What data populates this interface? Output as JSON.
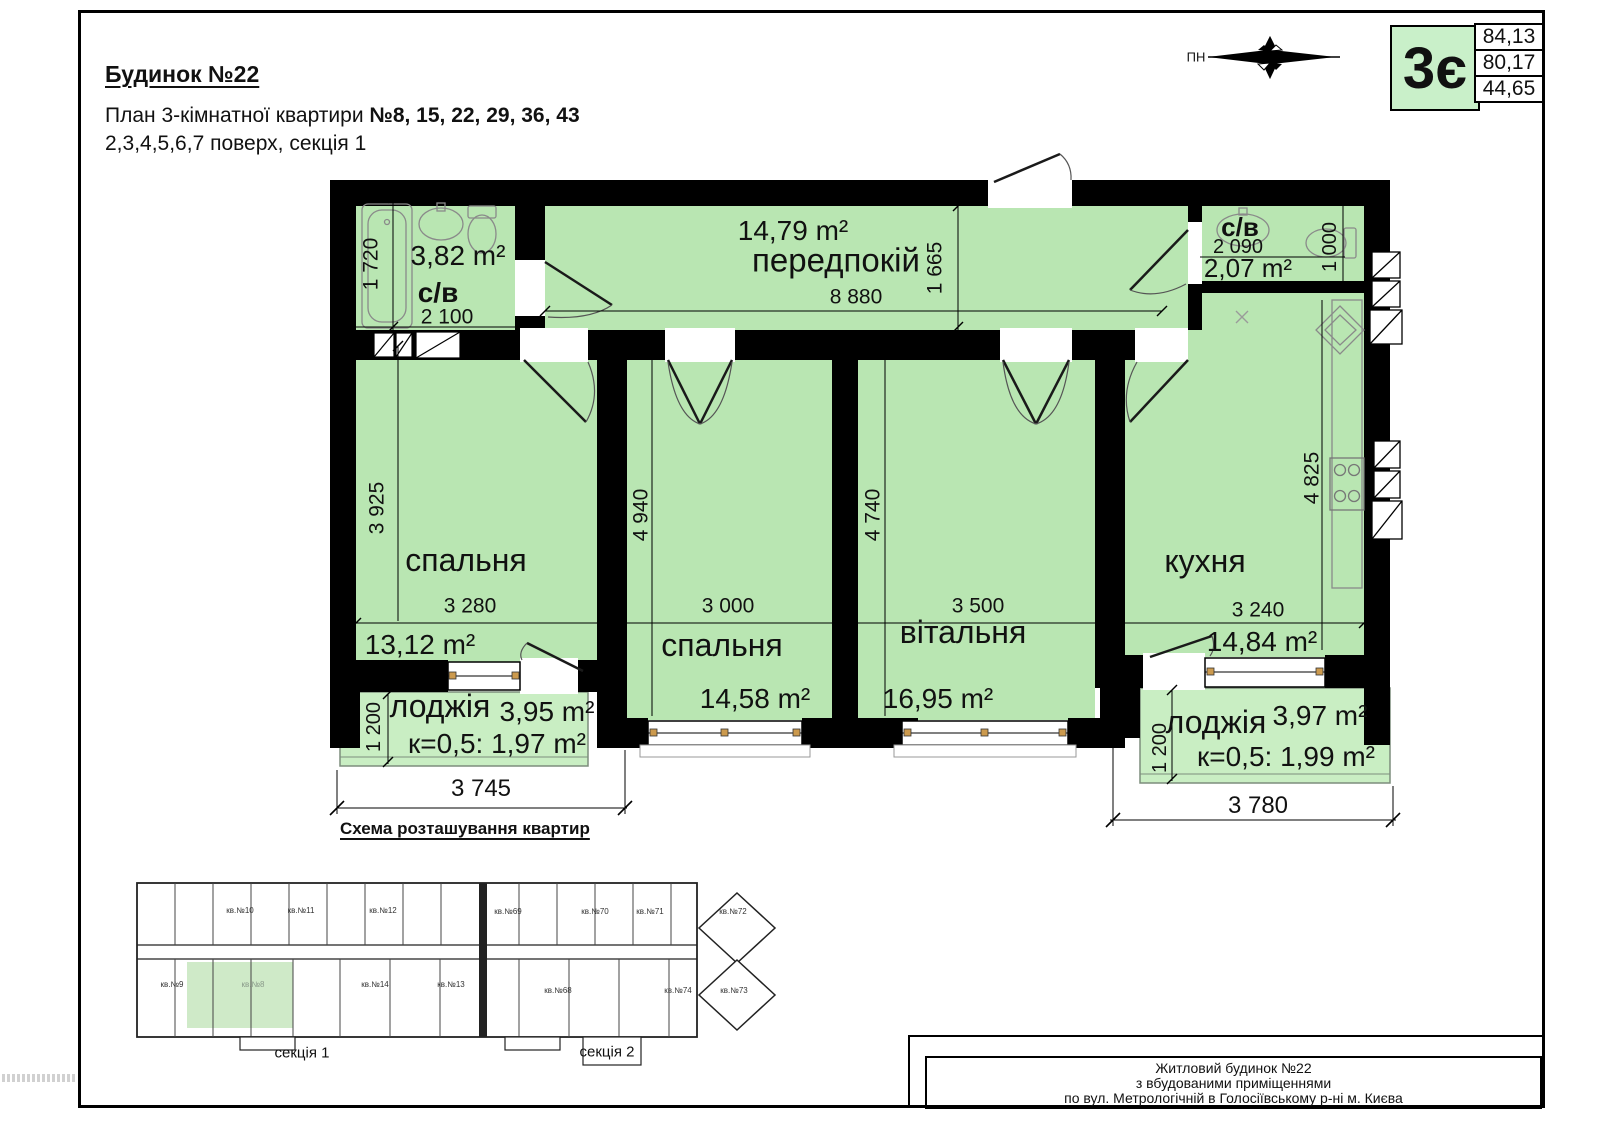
{
  "page": {
    "building_title": "Будинок №22",
    "plan_line_prefix": "План 3-кімнатної квартири ",
    "plan_line_numbers": "№8, 15, 22, 29, 36, 43",
    "floors_line": "2,3,4,5,6,7 поверх, секція 1",
    "compass_label": "ПН"
  },
  "legend": {
    "apartment_type": "3є",
    "areas": [
      "84,13",
      "80,17",
      "44,65"
    ]
  },
  "rooms": {
    "bath1": {
      "label": "с/в",
      "area": "3,82 m²",
      "width_dim": "2 100",
      "height_dim": "1 720"
    },
    "hall": {
      "label": "передпокій",
      "area": "14,79 m²",
      "width_dim": "8 880",
      "height_dim": "1 665"
    },
    "bath2": {
      "label": "с/в",
      "area": "2,07 m²",
      "width_dim": "2 090",
      "height_dim": "1 000"
    },
    "bedroom1": {
      "label": "спальня",
      "area": "13,12 m²",
      "width_dim": "3 280",
      "height_dim": "3 925"
    },
    "bedroom2": {
      "label": "спальня",
      "area": "14,58 m²",
      "width_dim": "3 000",
      "height_dim": "4 940"
    },
    "living": {
      "label": "вітальня",
      "area": "16,95 m²",
      "width_dim": "3 500",
      "height_dim": "4 740"
    },
    "kitchen": {
      "label": "кухня",
      "area": "14,84 m²",
      "width_dim": "3 240",
      "height_dim": "4 825"
    },
    "loggia1": {
      "label": "лоджія",
      "area": "3,95 m²",
      "coef": "к=0,5: 1,97 m²",
      "width_dim": "3 745",
      "height_dim": "1 200"
    },
    "loggia2": {
      "label": "лоджія",
      "area": "3,97 m²",
      "coef": "к=0,5: 1,99 m²",
      "width_dim": "3 780",
      "height_dim": "1 200"
    }
  },
  "scheme": {
    "title": "Схема розташування квартир",
    "sections": [
      "секція 1",
      "секція 2"
    ],
    "apartments_top": [
      "кв.№10",
      "кв.№11",
      "кв.№12",
      "кв.№69",
      "кв.№70",
      "кв.№71",
      "кв.№72"
    ],
    "apartments_bottom": [
      "кв.№9",
      "кв.№8",
      "кв.№14",
      "кв.№13",
      "кв.№68",
      "кв.№74",
      "кв.№73"
    ],
    "highlighted_apartment": "кв.№8"
  },
  "title_block": {
    "line1": "Житловий будинок  №22",
    "line2": "з вбудованими приміщеннями",
    "line3": "по вул. Метрологічній в Голосіївському р-ні м. Києва"
  },
  "colors": {
    "room_green": "#b9e6b2",
    "loggia_green": "#c9eec3",
    "highlight_green": "#cfeac8",
    "legend_green": "#c9f0c9",
    "wall": "#000000",
    "window_mark_tan": "#cc9a4e"
  }
}
